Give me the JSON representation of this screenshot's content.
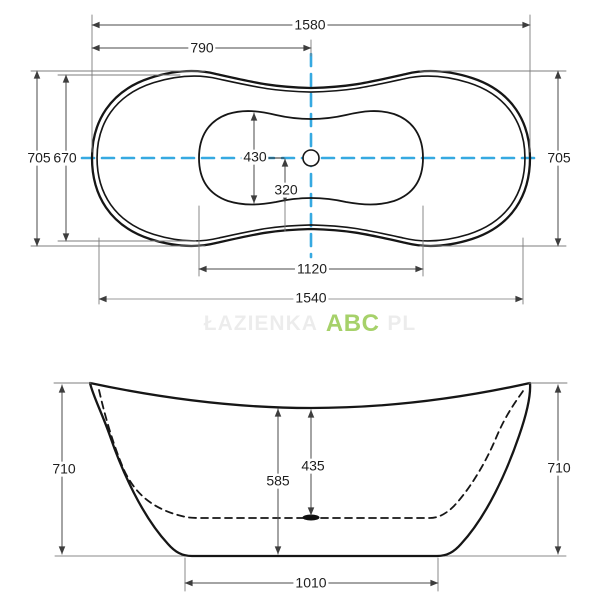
{
  "title": "Freestanding bathtub technical drawing (plan and side elevation)",
  "top_view": {
    "length_overall": "1580",
    "length_half": "790",
    "width_overall_left": "705",
    "width_inner": "670",
    "width_overall_right": "705",
    "basin_width": "430",
    "basin_half_width": "320",
    "basin_length": "1120",
    "length_lower": "1540"
  },
  "side_view": {
    "height_left": "710",
    "height_right": "710",
    "depth_to_drain": "435",
    "depth_to_floor": "585",
    "base_length": "1010"
  },
  "watermark": {
    "prefix": "ŁAZIENKA",
    "brand": "ABC",
    "suffix": "PL"
  },
  "colors": {
    "outline": "#161616",
    "dimension_line": "#4a4a4a",
    "centerline": "#36a9e1",
    "brand_green": "#a6d16a",
    "background": "#ffffff"
  }
}
